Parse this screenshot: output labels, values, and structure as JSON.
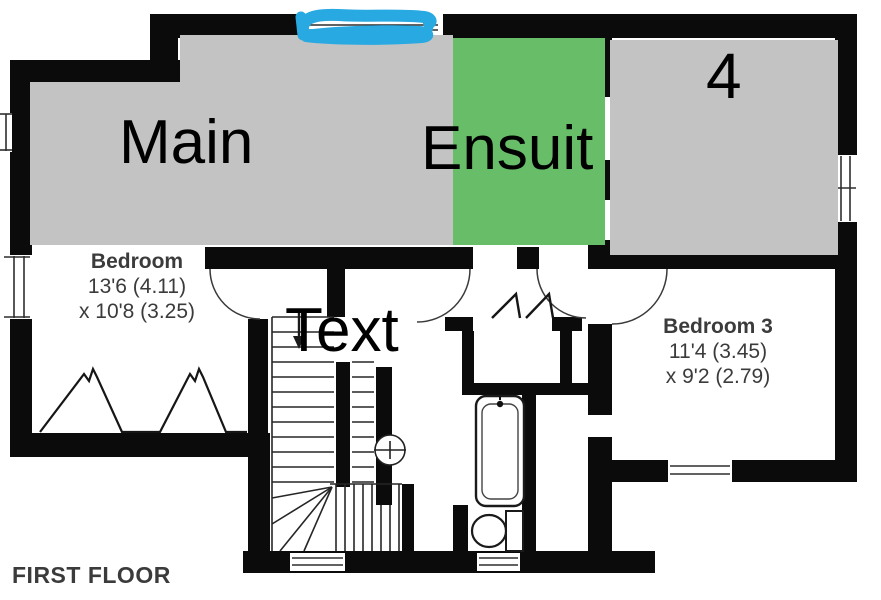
{
  "plan": {
    "floor_label": "FIRST FLOOR",
    "text_color": "#3b3b3b",
    "rooms": [
      {
        "name": "Bedroom",
        "dim_line1": "13'6 (4.11)",
        "dim_line2": "x 10'8 (3.25)"
      },
      {
        "name": "Bedroom 3",
        "dim_line1": "11'4 (3.45)",
        "dim_line2": "x 9'2 (2.79)"
      }
    ],
    "fixtures": [
      "stairs",
      "bath",
      "toilet",
      "wardrobe-zigzag",
      "windows",
      "door-arcs"
    ]
  },
  "annotations": {
    "rect_labels": {
      "main": "Main",
      "ensuite": "Ensuit",
      "bedroom4": "4"
    },
    "floating_text": "Text",
    "colors": {
      "room_gray": "#c3c3c3",
      "ensuite_green": "#67bd68",
      "marker_blue": "#29a9e2",
      "label_text": "#000000"
    }
  }
}
